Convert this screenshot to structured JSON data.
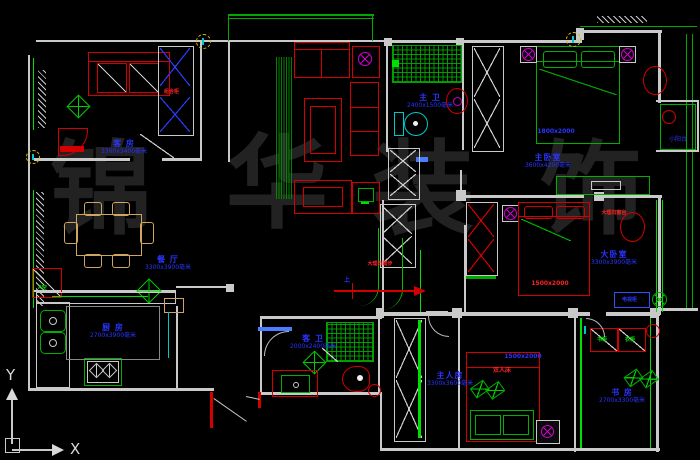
{
  "watermark": {
    "chars": [
      "锦",
      "华",
      "装",
      "饰"
    ]
  },
  "ucs": {
    "x_label": "X",
    "y_label": "Y"
  },
  "rooms": {
    "guest_room": {
      "name": "客 房",
      "dims": "3300x3400毫米"
    },
    "dining": {
      "name": "餐 厅",
      "dims": "3300x3900毫米"
    },
    "master_bath": {
      "name": "主 卫",
      "dims": "2400x1500毫米"
    },
    "master_bedroom": {
      "name": "主卧室",
      "dims": "3600x4200毫米"
    },
    "big_bedroom": {
      "name": "大卧室",
      "dims": "3300x3900毫米"
    },
    "kitchen": {
      "name": "厨 房",
      "dims": "2700x3900毫米"
    },
    "guest_bath": {
      "name": "客 卫",
      "dims": "2000x2400毫米"
    },
    "main_room": {
      "name": "主人房",
      "dims": "3300x3600毫米"
    },
    "study": {
      "name": "书 房",
      "dims": "2700x3300毫米"
    },
    "small_balcony": {
      "name": "小阳台"
    }
  },
  "annotations": {
    "marble_step": "大理石踏步",
    "up": "上",
    "window_sill": "大理石窗台",
    "combo_cabinet": "组合柜",
    "ac": "A空",
    "bookcase": "书柜",
    "wardrobe": "衣柜",
    "double_bed": "双人床",
    "master_bed_dim": "1800x2000",
    "big_bed_dim": "1500x2000",
    "main_bed_dim": "1500x2000",
    "tv_cabinet": "电视柜"
  },
  "colors": {
    "wall": "#c9c9c9",
    "green": "#00b000",
    "red": "#d40000",
    "label_blue": "#2a34ff",
    "cyan": "#00c8c8",
    "magenta": "#cc00cc",
    "wood_tan": "#cfa55f",
    "watermark_gray": "#222222",
    "background": "#000000"
  }
}
